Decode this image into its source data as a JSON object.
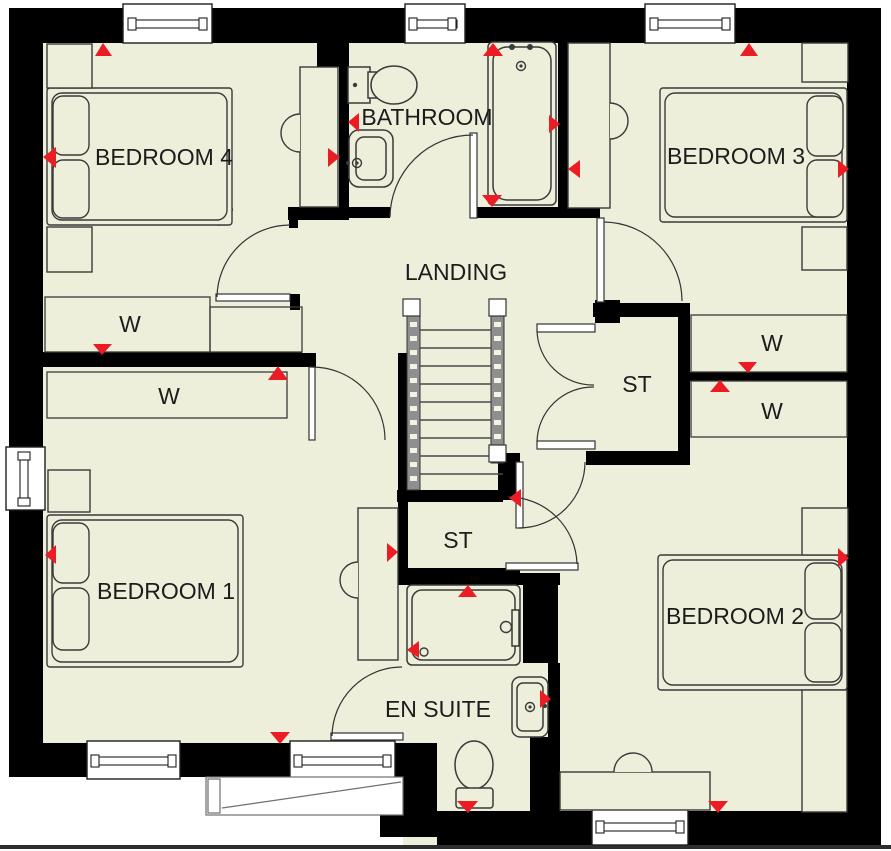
{
  "page": {
    "background": "#ffffff",
    "type": "floor-plan"
  },
  "colors": {
    "floor": "#edefdb",
    "wall": "#000000",
    "furniture_outline": "#3a3a3a",
    "marker_red": "#ec1c24",
    "window_fill": "#ffffff",
    "ground_line": "#2e2e2e",
    "label_text": "#1c1c1c"
  },
  "rooms": {
    "bedroom4": {
      "label": "BEDROOM 4"
    },
    "bathroom": {
      "label": "BATHROOM"
    },
    "bedroom3": {
      "label": "BEDROOM 3"
    },
    "landing": {
      "label": "LANDING"
    },
    "storage_upper": {
      "label": "ST"
    },
    "storage_lower": {
      "label": "ST"
    },
    "ensuite": {
      "label": "EN SUITE"
    },
    "bedroom1": {
      "label": "BEDROOM 1"
    },
    "bedroom2": {
      "label": "BEDROOM 2"
    },
    "wardrobe_bedroom4": {
      "label": "W"
    },
    "wardrobe_bedroom1": {
      "label": "W"
    },
    "wardrobe_bedroom3": {
      "label": "W"
    },
    "wardrobe_bedroom2": {
      "label": "W"
    }
  },
  "icons": {
    "direction_marker": "red-triangle",
    "bed": "double-bed-outline",
    "bath": "bathtub-outline",
    "shower": "shower-tray-outline",
    "toilet": "toilet-outline",
    "sink": "washbasin-outline",
    "stairs": "staircase-treads",
    "door": "quarter-arc-swing",
    "window": "framed-window"
  }
}
